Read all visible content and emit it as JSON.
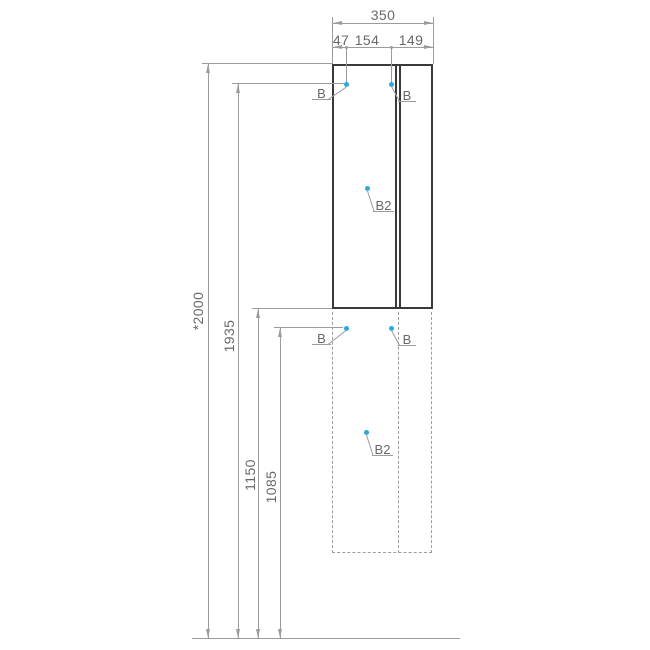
{
  "dims": {
    "width_total": "350",
    "width_segments": [
      "47",
      "154",
      "149"
    ],
    "height_total": "*2000",
    "height_upper_fixing": "1935",
    "height_lower_top": "1150",
    "height_lower_fixing": "1085"
  },
  "labels": {
    "b": "B",
    "b2": "B2"
  },
  "colors": {
    "outline": "#3a3a3a",
    "dimension": "#9c9c9c",
    "text": "#686868",
    "marker": "#29a9dd",
    "background": "#ffffff"
  }
}
